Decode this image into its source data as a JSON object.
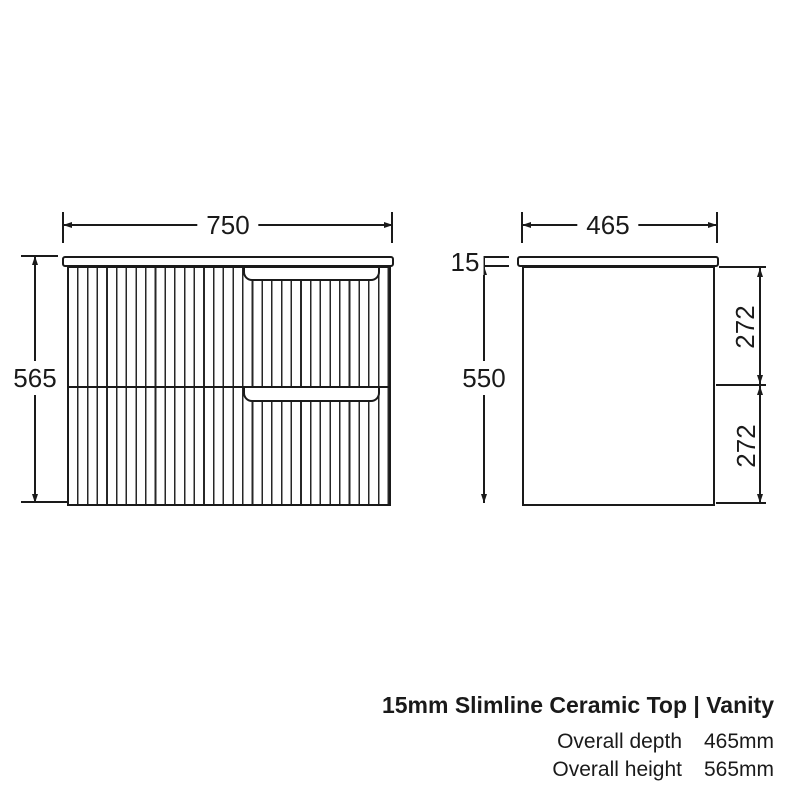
{
  "front_view": {
    "name": "vanity front elevation",
    "width": "750",
    "height": "565"
  },
  "side_view": {
    "name": "vanity side elevation",
    "depth": "465",
    "top_thickness": "15",
    "body_height": "550",
    "drawer_top": "272",
    "drawer_bottom": "272"
  },
  "caption": {
    "title": "15mm Slimline Ceramic Top | Vanity",
    "specs": [
      {
        "label": "Overall depth",
        "value": "465mm"
      },
      {
        "label": "Overall height",
        "value": "565mm"
      }
    ]
  },
  "colors": {
    "line": "#1a1a1a",
    "background": "#ffffff"
  }
}
